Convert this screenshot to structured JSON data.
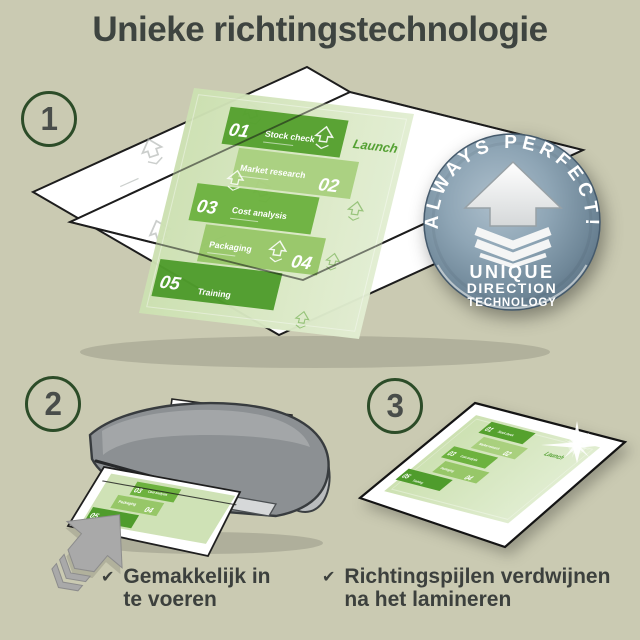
{
  "title": "Unieke richtingstechnologie",
  "steps": {
    "step1": {
      "number": "1"
    },
    "step2": {
      "number": "2",
      "caption": [
        "Gemakkelijk in",
        "te voeren"
      ]
    },
    "step3": {
      "number": "3",
      "caption": [
        "Richtingspijlen verdwijnen",
        "na het lamineren"
      ]
    }
  },
  "badge": {
    "arc_text": "ALWAYS PERFECT!",
    "line1": "UNIQUE",
    "line2": "DIRECTION",
    "line3": "TECHNOLOGY"
  },
  "document": {
    "heading": "Launch",
    "blocks": [
      {
        "num": "01",
        "label": "Stock check"
      },
      {
        "num": "02",
        "label": "Market research"
      },
      {
        "num": "03",
        "label": "Cost analysis"
      },
      {
        "num": "04",
        "label": "Packaging"
      },
      {
        "num": "05",
        "label": "Training"
      }
    ]
  },
  "icons": {
    "check": "✔"
  },
  "colors": {
    "background": "#cacab2",
    "title_text": "#3e4440",
    "accent_green": "#55a12e",
    "block_greens": [
      "#55a12e",
      "#a9d07e",
      "#6db23f",
      "#97c768",
      "#4f9c2c"
    ],
    "doc_background": "#cde1b2",
    "badge_blue": "#8ea5b5",
    "laminator_gray": "#8c9093",
    "pouch_white": "#ffffff",
    "circle_green": "#2c4c28"
  }
}
